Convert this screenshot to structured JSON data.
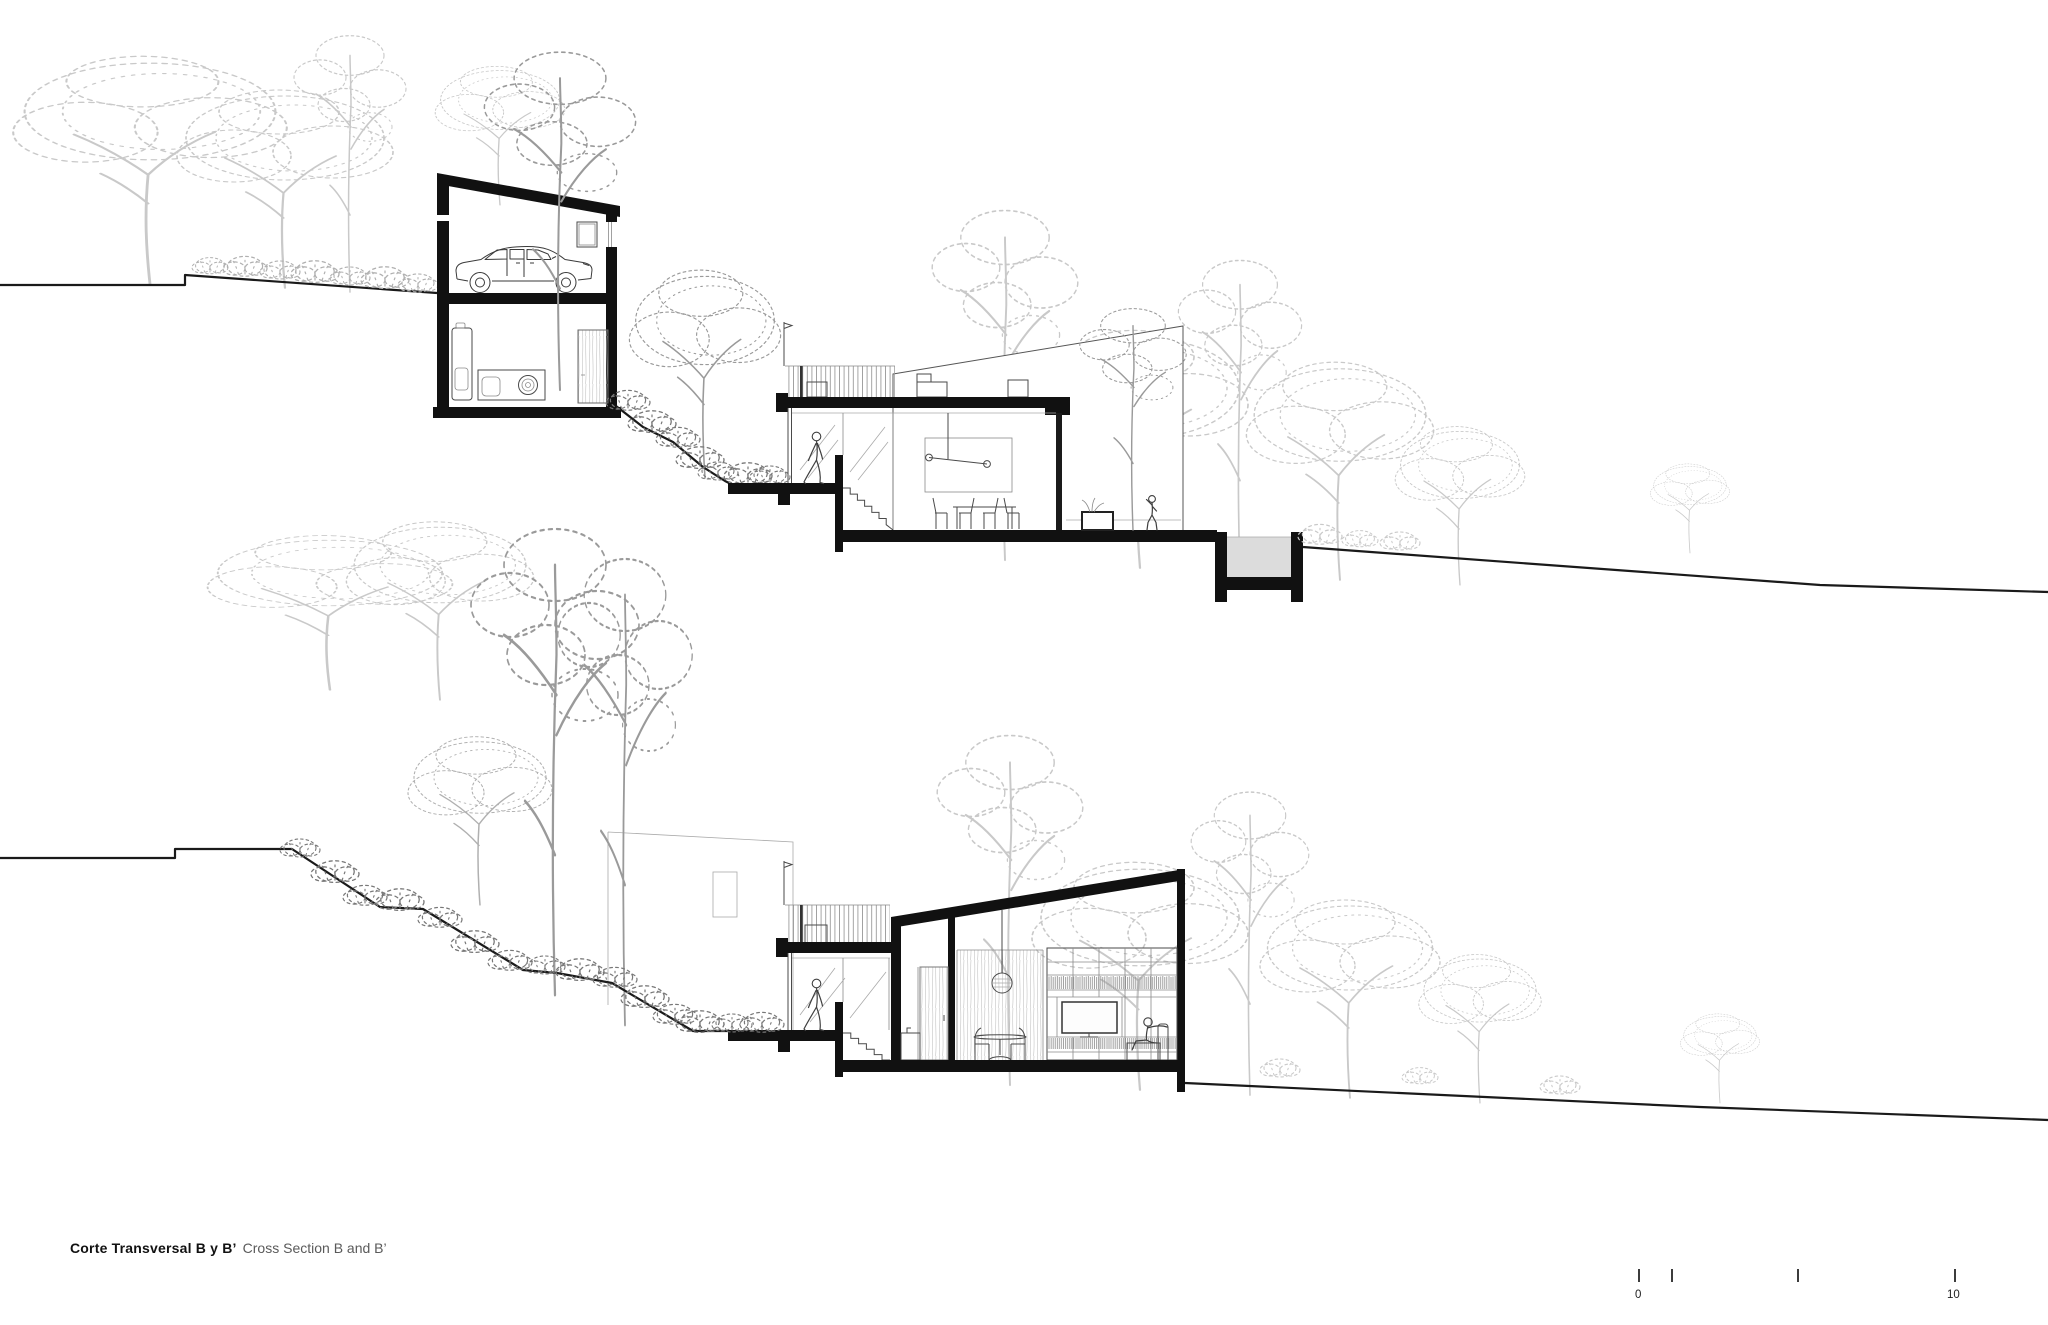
{
  "document": {
    "kind": "architectural cross-section drawing",
    "background": "#ffffff",
    "ink_color": "#111111",
    "vegetation_light": "#c9c9c9",
    "vegetation_mid": "#9a9a9a",
    "vegetation_dark": "#787878",
    "pool_fill": "#dcdcdc"
  },
  "title": {
    "primary": "Corte Transversal B y B’",
    "secondary": "Cross Section B and B’"
  },
  "scale_bar": {
    "start_label": "0",
    "end_label": "10"
  }
}
